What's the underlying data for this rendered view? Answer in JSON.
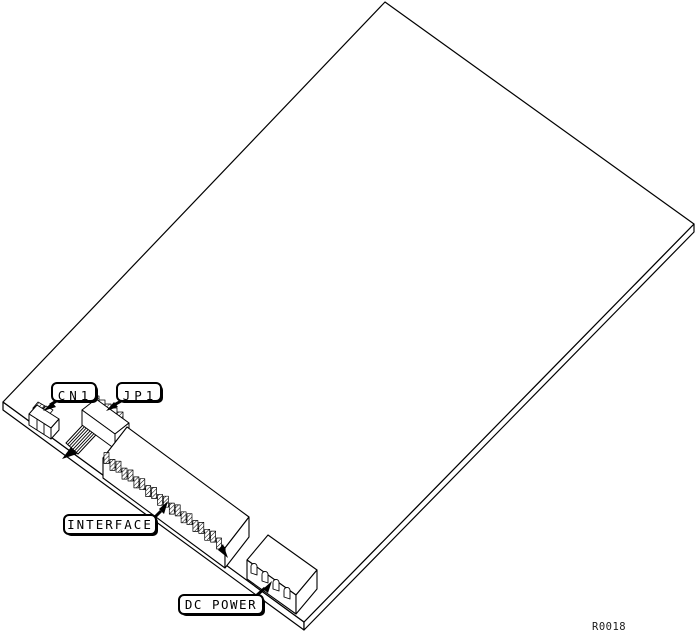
{
  "diagram": {
    "type": "technical-line-illustration",
    "subject": "circuit board connector location drawing",
    "background_color": "#ffffff",
    "line_color": "#000000",
    "callouts": [
      {
        "id": "cn1",
        "label": "CN1"
      },
      {
        "id": "jp1",
        "label": "JP1"
      },
      {
        "id": "interface",
        "label": "INTERFACE"
      },
      {
        "id": "dc-power",
        "label": "DC POWER"
      }
    ],
    "reference_code": "R0018"
  }
}
